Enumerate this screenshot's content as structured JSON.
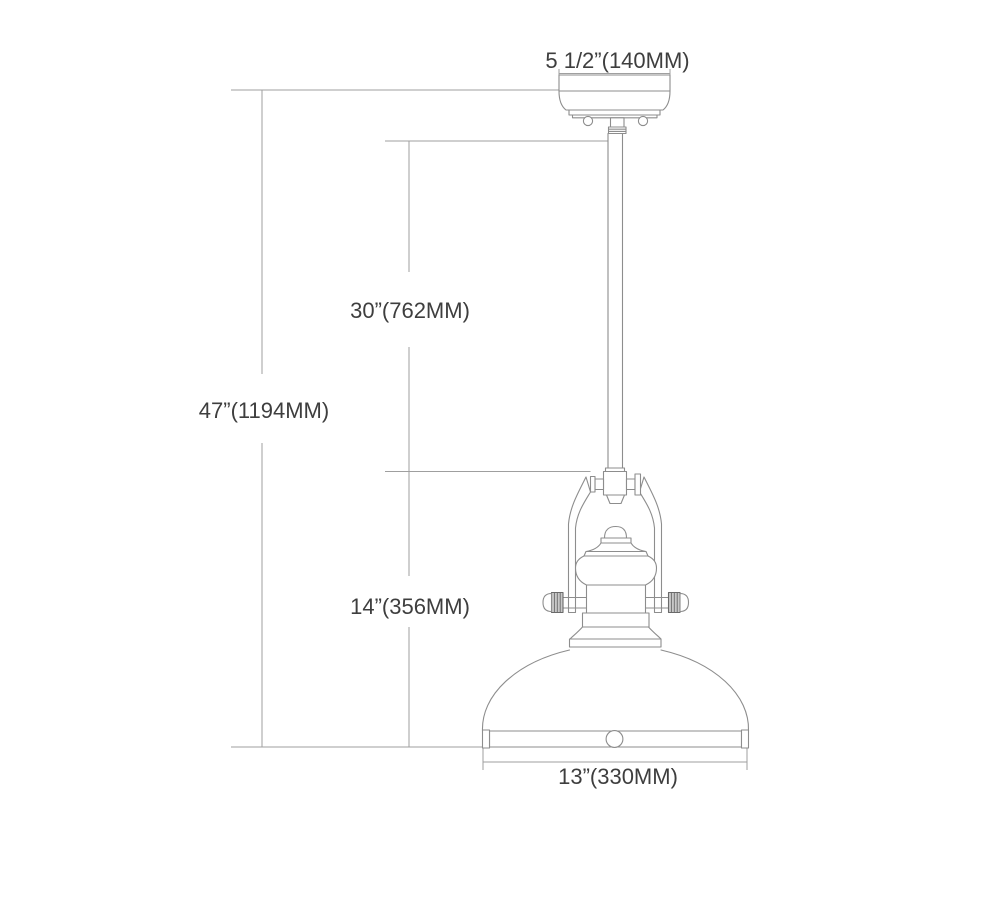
{
  "diagram": {
    "type": "pendant-light-fixture-dimension-drawing",
    "dimensions": {
      "canopy_width": "5 1/2”(140MM)",
      "rod_length": "30”(762MM)",
      "overall_height": "47”(1194MM)",
      "fixture_height": "14”(356MM)",
      "shade_width": "13”(330MM)"
    },
    "colors": {
      "background": "#ffffff",
      "drawing_line": "#8d8d8d",
      "dimension_line": "#9f9f9f",
      "label_text": "#3e3e3e"
    }
  }
}
